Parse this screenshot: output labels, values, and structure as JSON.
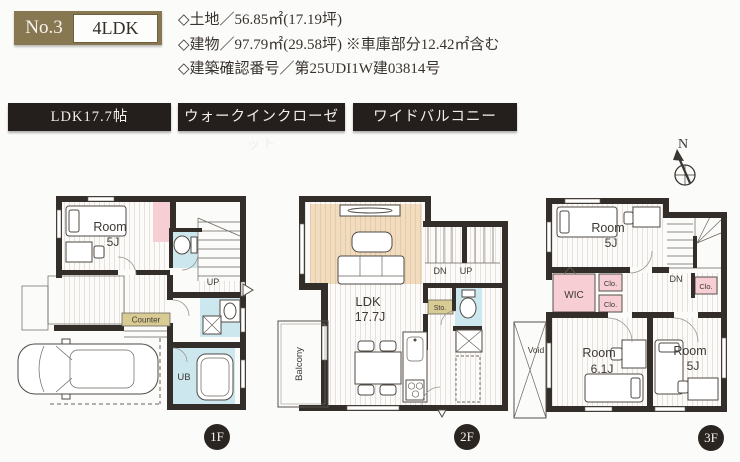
{
  "header": {
    "no_label": "No.3",
    "type_label": "4LDK",
    "detail_land": "◇土地／56.85㎡(17.19坪)",
    "detail_building": "◇建物／97.79㎡(29.58坪) ※車庫部分12.42㎡含む",
    "detail_permit": "◇建築確認番号／第25UDI1W建03814号"
  },
  "features": [
    "LDK17.7帖",
    "ウォークインクローゼット",
    "ワイドバルコニー"
  ],
  "compass": {
    "north": "N"
  },
  "floor1": {
    "badge": "1F",
    "room_word": "Room",
    "room_size": "5J",
    "up": "UP",
    "counter": "Counter",
    "ub": "UB"
  },
  "floor2": {
    "badge": "2F",
    "ldk_word": "LDK",
    "ldk_size": "17.7J",
    "dn": "DN",
    "up": "UP",
    "sto": "Sto.",
    "balcony": "Balcony"
  },
  "floor3": {
    "badge": "3F",
    "room_top_word": "Room",
    "room_top_size": "5J",
    "dn": "DN",
    "wic": "WIC",
    "clo_a": "Clo.",
    "clo_b": "Clo.",
    "clo_c": "Clo.",
    "void": "Void",
    "room_mid_word": "Room",
    "room_mid_size": "6.1J",
    "room_right_word": "Room",
    "room_right_size": "5J"
  },
  "colors": {
    "accent_khaki": "#887852",
    "banner_bg": "#241f1c",
    "wall": "#342e2a",
    "pink": "#f6ced3",
    "light_blue": "#cde7ee",
    "tan": "#d9cb94",
    "rug_beige": "#f1dcc0"
  }
}
